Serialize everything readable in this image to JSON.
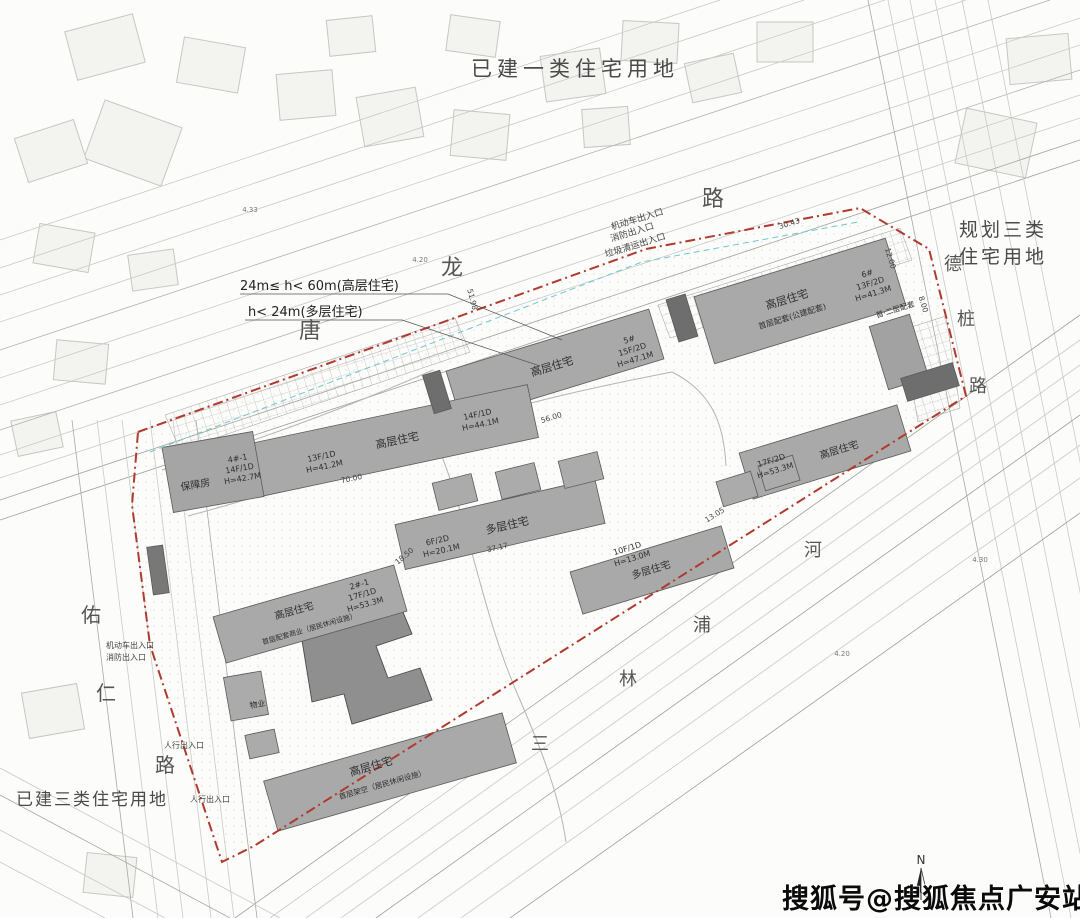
{
  "colors": {
    "site_boundary_red": "#b03a2e",
    "building_gray": "#a9a9a9",
    "dark_block_gray": "#6e6e6e",
    "cyan_dashed": "#6cc8cf",
    "label_dark": "#333333",
    "watermark_black": "#0b0b0b"
  },
  "land_use_labels": [
    {
      "t": "已建一类住宅用地",
      "x": 575,
      "y": 76,
      "s": 21,
      "ls": 5
    },
    {
      "t": "规划三类",
      "x": 1003,
      "y": 236,
      "s": 19,
      "ls": 3
    },
    {
      "t": "住宅用地",
      "x": 1003,
      "y": 263,
      "s": 19,
      "ls": 3
    },
    {
      "t": "已建三类住宅用地",
      "x": 92,
      "y": 805,
      "s": 17,
      "ls": 2
    }
  ],
  "roads": [
    {
      "name": "唐龙路",
      "size": 22,
      "chars": [
        {
          "c": "唐",
          "x": 310,
          "y": 338
        },
        {
          "c": "龙",
          "x": 452,
          "y": 275
        },
        {
          "c": "路",
          "x": 713,
          "y": 206
        }
      ]
    },
    {
      "name": "德桩路",
      "size": 18,
      "chars": [
        {
          "c": "德",
          "x": 953,
          "y": 270
        },
        {
          "c": "桩",
          "x": 966,
          "y": 325
        },
        {
          "c": "路",
          "x": 978,
          "y": 392
        }
      ]
    },
    {
      "name": "佑仁路",
      "size": 20,
      "chars": [
        {
          "c": "佑",
          "x": 91,
          "y": 622
        },
        {
          "c": "仁",
          "x": 106,
          "y": 700
        },
        {
          "c": "路",
          "x": 165,
          "y": 772
        }
      ]
    },
    {
      "name": "三林浦河",
      "size": 18,
      "chars": [
        {
          "c": "三",
          "x": 540,
          "y": 750
        },
        {
          "c": "林",
          "x": 628,
          "y": 685
        },
        {
          "c": "浦",
          "x": 702,
          "y": 631
        },
        {
          "c": "河",
          "x": 813,
          "y": 556
        }
      ]
    }
  ],
  "height_notes": [
    {
      "t": "24m≤ h< 60m(高层住宅)",
      "x": 240,
      "y": 290,
      "s": 13
    },
    {
      "t": "h< 24m(多层住宅)",
      "x": 248,
      "y": 316,
      "s": 13
    }
  ],
  "entrance_labels": [
    {
      "t": "机动车出入口",
      "x": 638,
      "y": 222,
      "s": 9,
      "r": -17
    },
    {
      "t": "消防出入口",
      "x": 633,
      "y": 235,
      "s": 9,
      "r": -17
    },
    {
      "t": "垃圾清运出入口",
      "x": 636,
      "y": 248,
      "s": 9,
      "r": -17
    },
    {
      "t": "机动车出入口",
      "x": 130,
      "y": 648,
      "s": 8
    },
    {
      "t": "消防出入口",
      "x": 126,
      "y": 660,
      "s": 8
    },
    {
      "t": "人行出入口",
      "x": 184,
      "y": 748,
      "s": 8
    },
    {
      "t": "人行出入口",
      "x": 210,
      "y": 802,
      "s": 8
    }
  ],
  "building_labels": [
    {
      "t": "高层住宅",
      "x": 553,
      "y": 370,
      "s": 11,
      "r": -17
    },
    {
      "t": "5#",
      "x": 630,
      "y": 342,
      "s": 8,
      "r": -17
    },
    {
      "t": "15F/2D",
      "x": 633,
      "y": 352,
      "s": 8,
      "r": -17
    },
    {
      "t": "H=47.1M",
      "x": 636,
      "y": 362,
      "s": 8,
      "r": -17
    },
    {
      "t": "高层住宅",
      "x": 788,
      "y": 303,
      "s": 11,
      "r": -17
    },
    {
      "t": "首层配套(公建配套)",
      "x": 793,
      "y": 319,
      "s": 8,
      "r": -17
    },
    {
      "t": "6#",
      "x": 868,
      "y": 276,
      "s": 8,
      "r": -17
    },
    {
      "t": "13F/2D",
      "x": 871,
      "y": 286,
      "s": 8,
      "r": -17
    },
    {
      "t": "H=41.3M",
      "x": 874,
      "y": 296,
      "s": 8,
      "r": -17
    },
    {
      "t": "首·二层配套",
      "x": 896,
      "y": 312,
      "s": 7.5,
      "r": -17
    },
    {
      "t": "高层住宅",
      "x": 398,
      "y": 444,
      "s": 11,
      "r": -12
    },
    {
      "t": "13F/1D",
      "x": 322,
      "y": 459,
      "s": 8,
      "r": -12
    },
    {
      "t": "H=41.2M",
      "x": 325,
      "y": 469,
      "s": 8,
      "r": -12
    },
    {
      "t": "14F/1D",
      "x": 478,
      "y": 417,
      "s": 8,
      "r": -12
    },
    {
      "t": "H=44.1M",
      "x": 481,
      "y": 427,
      "s": 8,
      "r": -12
    },
    {
      "t": "保障房",
      "x": 196,
      "y": 488,
      "s": 10,
      "r": -10
    },
    {
      "t": "4#-1",
      "x": 238,
      "y": 461,
      "s": 8,
      "r": -10
    },
    {
      "t": "14F/1D",
      "x": 240,
      "y": 471,
      "s": 8,
      "r": -10
    },
    {
      "t": "H=42.7M",
      "x": 243,
      "y": 481,
      "s": 8,
      "r": -10
    },
    {
      "t": "多层住宅",
      "x": 508,
      "y": 529,
      "s": 11,
      "r": -13
    },
    {
      "t": "6F/2D",
      "x": 438,
      "y": 543,
      "s": 8,
      "r": -13
    },
    {
      "t": "H=20.1M",
      "x": 442,
      "y": 553,
      "s": 8,
      "r": -13
    },
    {
      "t": "高层住宅",
      "x": 295,
      "y": 614,
      "s": 10,
      "r": -16
    },
    {
      "t": "首层配套商业（居民休闲设施）",
      "x": 310,
      "y": 631,
      "s": 7,
      "r": -16
    },
    {
      "t": "2#-1",
      "x": 360,
      "y": 587,
      "s": 8,
      "r": -16
    },
    {
      "t": "17F/1D",
      "x": 363,
      "y": 597,
      "s": 8,
      "r": -16
    },
    {
      "t": "H=53.3M",
      "x": 366,
      "y": 607,
      "s": 8,
      "r": -16
    },
    {
      "t": "高层住宅",
      "x": 372,
      "y": 770,
      "s": 11,
      "r": -16
    },
    {
      "t": "首层架空（居民休闲设施）",
      "x": 383,
      "y": 787,
      "s": 7.5,
      "r": -16
    },
    {
      "t": "物业",
      "x": 258,
      "y": 707,
      "s": 8,
      "r": -10
    },
    {
      "t": "多层住宅",
      "x": 652,
      "y": 573,
      "s": 10,
      "r": -17
    },
    {
      "t": "10F/1D",
      "x": 628,
      "y": 551,
      "s": 8,
      "r": -17
    },
    {
      "t": "H=13.0M",
      "x": 633,
      "y": 561,
      "s": 8,
      "r": -17
    },
    {
      "t": "高层住宅",
      "x": 840,
      "y": 453,
      "s": 10,
      "r": -17
    },
    {
      "t": "17F/2D",
      "x": 772,
      "y": 463,
      "s": 8,
      "r": -17
    },
    {
      "t": "H=53.3M",
      "x": 776,
      "y": 473,
      "s": 8,
      "r": -17
    }
  ],
  "dimension_labels": [
    {
      "t": "56.00",
      "x": 552,
      "y": 420,
      "s": 7.5,
      "r": -17
    },
    {
      "t": "70.00",
      "x": 352,
      "y": 481,
      "s": 7.5,
      "r": -12
    },
    {
      "t": "37.17",
      "x": 498,
      "y": 550,
      "s": 7.5,
      "r": -13
    },
    {
      "t": "18.50",
      "x": 406,
      "y": 558,
      "s": 7.5,
      "r": -40
    },
    {
      "t": "13.05",
      "x": 716,
      "y": 517,
      "s": 7.5,
      "r": -32
    },
    {
      "t": "30.43",
      "x": 790,
      "y": 226,
      "s": 7.5,
      "r": -17
    },
    {
      "t": "12.00",
      "x": 888,
      "y": 259,
      "s": 7.5,
      "r": 73
    },
    {
      "t": "8.00",
      "x": 921,
      "y": 305,
      "s": 7.5,
      "r": 73
    },
    {
      "t": "51.98",
      "x": 470,
      "y": 300,
      "s": 7.5,
      "r": 75
    }
  ],
  "spot_elevations": [
    {
      "t": "4.20",
      "x": 842,
      "y": 656,
      "s": 7
    },
    {
      "t": "4.20",
      "x": 420,
      "y": 262,
      "s": 7
    },
    {
      "t": "4.33",
      "x": 250,
      "y": 212,
      "s": 7
    },
    {
      "t": "4.30",
      "x": 980,
      "y": 562,
      "s": 7
    }
  ],
  "building_blocks": [
    [
      555,
      365,
      212,
      52,
      -17,
      "#a9a9a9"
    ],
    [
      800,
      301,
      200,
      70,
      -17,
      "#a9a9a9"
    ],
    [
      899,
      352,
      42,
      66,
      -17,
      "#a2a2a2"
    ],
    [
      392,
      441,
      288,
      54,
      -12,
      "#a9a9a9"
    ],
    [
      213,
      472,
      92,
      66,
      -10,
      "#a5a5a5"
    ],
    [
      500,
      524,
      205,
      46,
      -13,
      "#a9a9a9"
    ],
    [
      455,
      492,
      40,
      28,
      -14,
      "#ababab"
    ],
    [
      518,
      481,
      40,
      28,
      -14,
      "#ababab"
    ],
    [
      581,
      470,
      40,
      28,
      -14,
      "#ababab"
    ],
    [
      310,
      614,
      188,
      48,
      -16,
      "#a9a9a9"
    ],
    [
      390,
      772,
      248,
      52,
      -16,
      "#a9a9a9"
    ],
    [
      246,
      696,
      38,
      44,
      -10,
      "#ababab"
    ],
    [
      262,
      744,
      30,
      24,
      -12,
      "#ababab"
    ],
    [
      652,
      570,
      158,
      44,
      -17,
      "#a9a9a9"
    ],
    [
      825,
      452,
      165,
      48,
      -17,
      "#a9a9a9"
    ],
    [
      737,
      489,
      36,
      26,
      -17,
      "#ababab"
    ],
    [
      779,
      473,
      36,
      26,
      -17,
      "#ababab"
    ],
    [
      437,
      392,
      18,
      40,
      -17,
      "#6e6e6e"
    ],
    [
      682,
      318,
      20,
      44,
      -17,
      "#6e6e6e"
    ],
    [
      930,
      382,
      24,
      54,
      73,
      "#6e6e6e"
    ],
    [
      158,
      570,
      16,
      48,
      -8,
      "#787878"
    ]
  ],
  "watermark": {
    "text": "搜狐号@搜狐焦点广安站"
  },
  "north": {
    "label": "N"
  }
}
